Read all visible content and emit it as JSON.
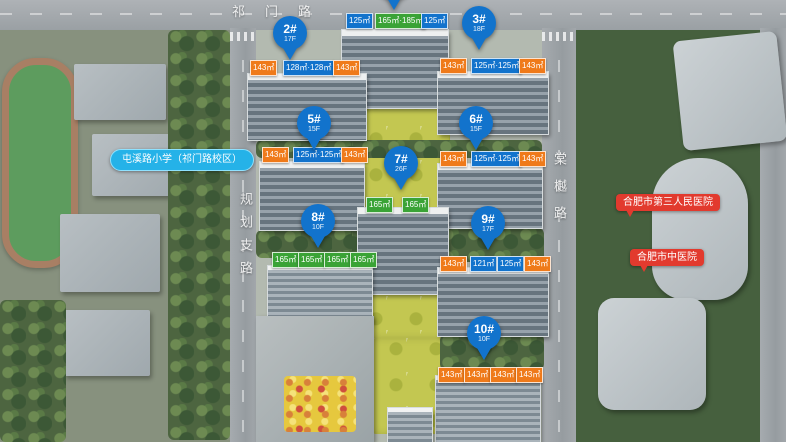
{
  "palette": {
    "pin_blue": "#1273cc",
    "label_orange": "#ef7a1a",
    "label_blue": "#1273cc",
    "label_green": "#3aa336",
    "school_pill_blue": "#25b2e8",
    "hospital_red": "#e23a2e"
  },
  "roads": {
    "top": "祁门路",
    "left": "规划支路",
    "right": "棠樾路"
  },
  "pois": {
    "school": "屯溪路小学（祁门路校区）",
    "hospital_1": "合肥市第三人民医院",
    "hospital_2": "合肥市中医院"
  },
  "pins": [
    {
      "id": "2#",
      "floors": "17F"
    },
    {
      "id": "3#",
      "floors": "18F"
    },
    {
      "id": "5#",
      "floors": "15F"
    },
    {
      "id": "6#",
      "floors": "15F"
    },
    {
      "id": "7#",
      "floors": "26F"
    },
    {
      "id": "8#",
      "floors": "10F"
    },
    {
      "id": "9#",
      "floors": "17F"
    },
    {
      "id": "10#",
      "floors": "10F"
    }
  ],
  "unit_labels": {
    "t1": [
      "125㎡",
      "165㎡·185㎡",
      "125㎡"
    ],
    "b2": [
      "143㎡",
      "128㎡·128㎡",
      "143㎡"
    ],
    "b3": [
      "143㎡",
      "125㎡·125㎡",
      "143㎡"
    ],
    "b5": [
      "143㎡",
      "125㎡·125㎡",
      "143㎡"
    ],
    "b6": [
      "143㎡",
      "125㎡·125㎡",
      "143㎡"
    ],
    "b7": [
      "165㎡",
      "165㎡"
    ],
    "b8": [
      "165㎡",
      "165㎡",
      "165㎡",
      "165㎡"
    ],
    "b9": [
      "143㎡",
      "121㎡",
      "125㎡",
      "143㎡"
    ],
    "b10": [
      "143㎡",
      "143㎡",
      "143㎡",
      "143㎡"
    ]
  }
}
